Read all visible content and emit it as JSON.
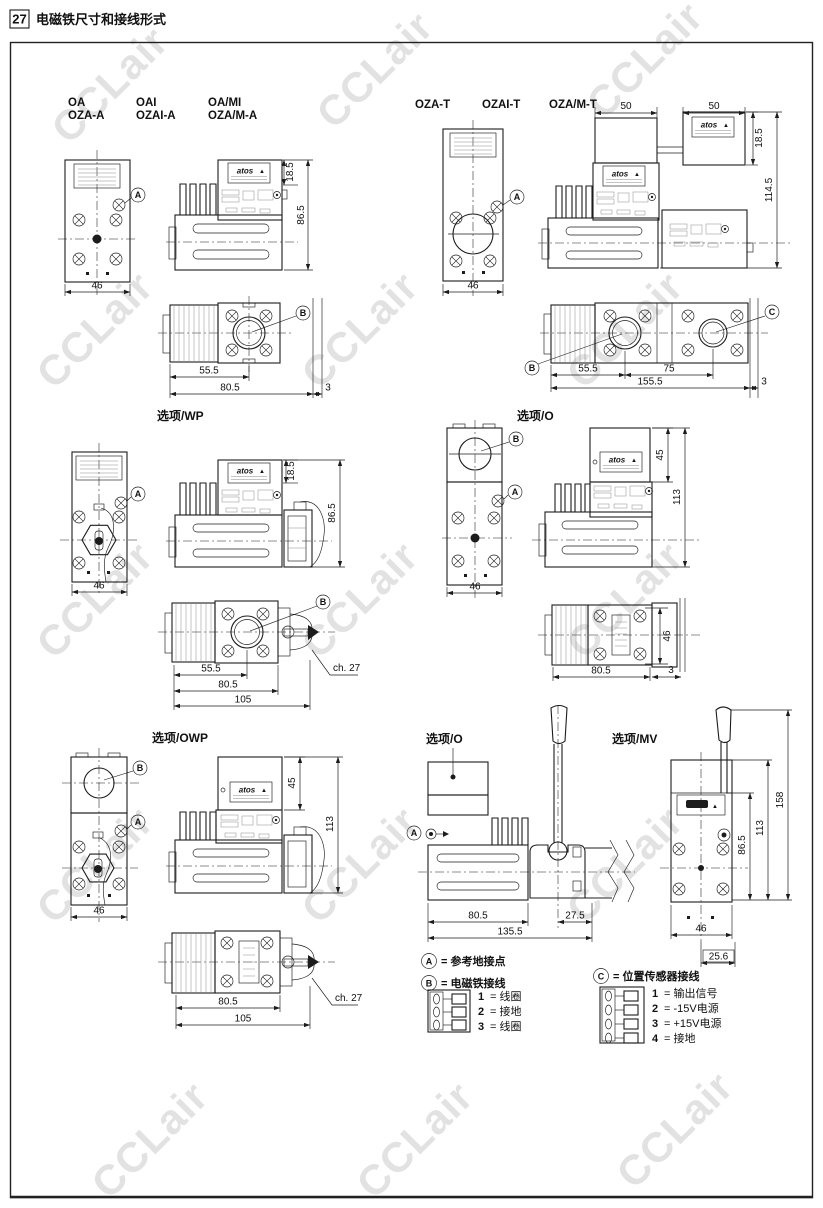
{
  "header": {
    "page_number": "27",
    "title": "电磁铁尺寸和接线形式"
  },
  "watermark": "CCLair",
  "brand": {
    "name": "atos",
    "warning": "▲"
  },
  "markers": {
    "a": "A",
    "b": "B",
    "c": "C"
  },
  "series_a": {
    "models": {
      "c1l1": "OA",
      "c1l2": "OZA-A",
      "c2l1": "OAI",
      "c2l2": "OZAI-A",
      "c3l1": "OA/MI",
      "c3l2": "OZA/M-A"
    },
    "front": {
      "width": "46"
    },
    "side": {
      "top_h": "18.5",
      "height": "86.5"
    },
    "bottom": {
      "d1": "55.5",
      "d2": "80.5",
      "d3": "3"
    }
  },
  "series_t": {
    "models": {
      "c1": "OZA-T",
      "c2": "OZAI-T",
      "c3": "OZA/M-T"
    },
    "front": {
      "width": "46"
    },
    "side": {
      "w1": "50",
      "w2": "50",
      "top_h": "18.5",
      "height": "114.5"
    },
    "bottom": {
      "d1": "55.5",
      "d2": "75",
      "d3": "155.5",
      "d4": "3"
    }
  },
  "option_wp": {
    "label": "选项/WP",
    "front": {
      "width": "46"
    },
    "side": {
      "top_h": "18.5",
      "height": "86.5"
    },
    "bottom": {
      "d1": "55.5",
      "d2": "80.5",
      "d3": "105",
      "hex": "ch. 27"
    }
  },
  "option_o": {
    "label": "选项/O",
    "front": {
      "width": "46"
    },
    "side": {
      "top_h": "45",
      "height": "113"
    },
    "bottom": {
      "d1": "80.5",
      "d2": "3",
      "depth": "46"
    }
  },
  "option_owp": {
    "label": "选项/OWP",
    "front": {
      "width": "46"
    },
    "side": {
      "top_h": "45",
      "height": "113"
    },
    "bottom": {
      "d1": "80.5",
      "d2": "105",
      "hex": "ch. 27"
    }
  },
  "option_o_lever": {
    "label": "选项/O",
    "dims": {
      "d1": "80.5",
      "d2": "27.5",
      "d3": "135.5"
    }
  },
  "option_mv": {
    "label": "选项/MV",
    "dims": {
      "total_h": "158",
      "h2": "113",
      "h3": "86.5",
      "width": "46",
      "offset": "25.6"
    }
  },
  "legend": {
    "a_text": "= 参考地接点",
    "b_text": "= 电磁铁接线",
    "c_text": "= 位置传感器接线",
    "b_pins": [
      {
        "n": "1",
        "t": "= 线圈"
      },
      {
        "n": "2",
        "t": "= 接地"
      },
      {
        "n": "3",
        "t": "= 线圈"
      }
    ],
    "c_pins": [
      {
        "n": "1",
        "t": "= 输出信号"
      },
      {
        "n": "2",
        "t": "= -15V电源"
      },
      {
        "n": "3",
        "t": "= +15V电源"
      },
      {
        "n": "4",
        "t": "= 接地"
      }
    ]
  }
}
